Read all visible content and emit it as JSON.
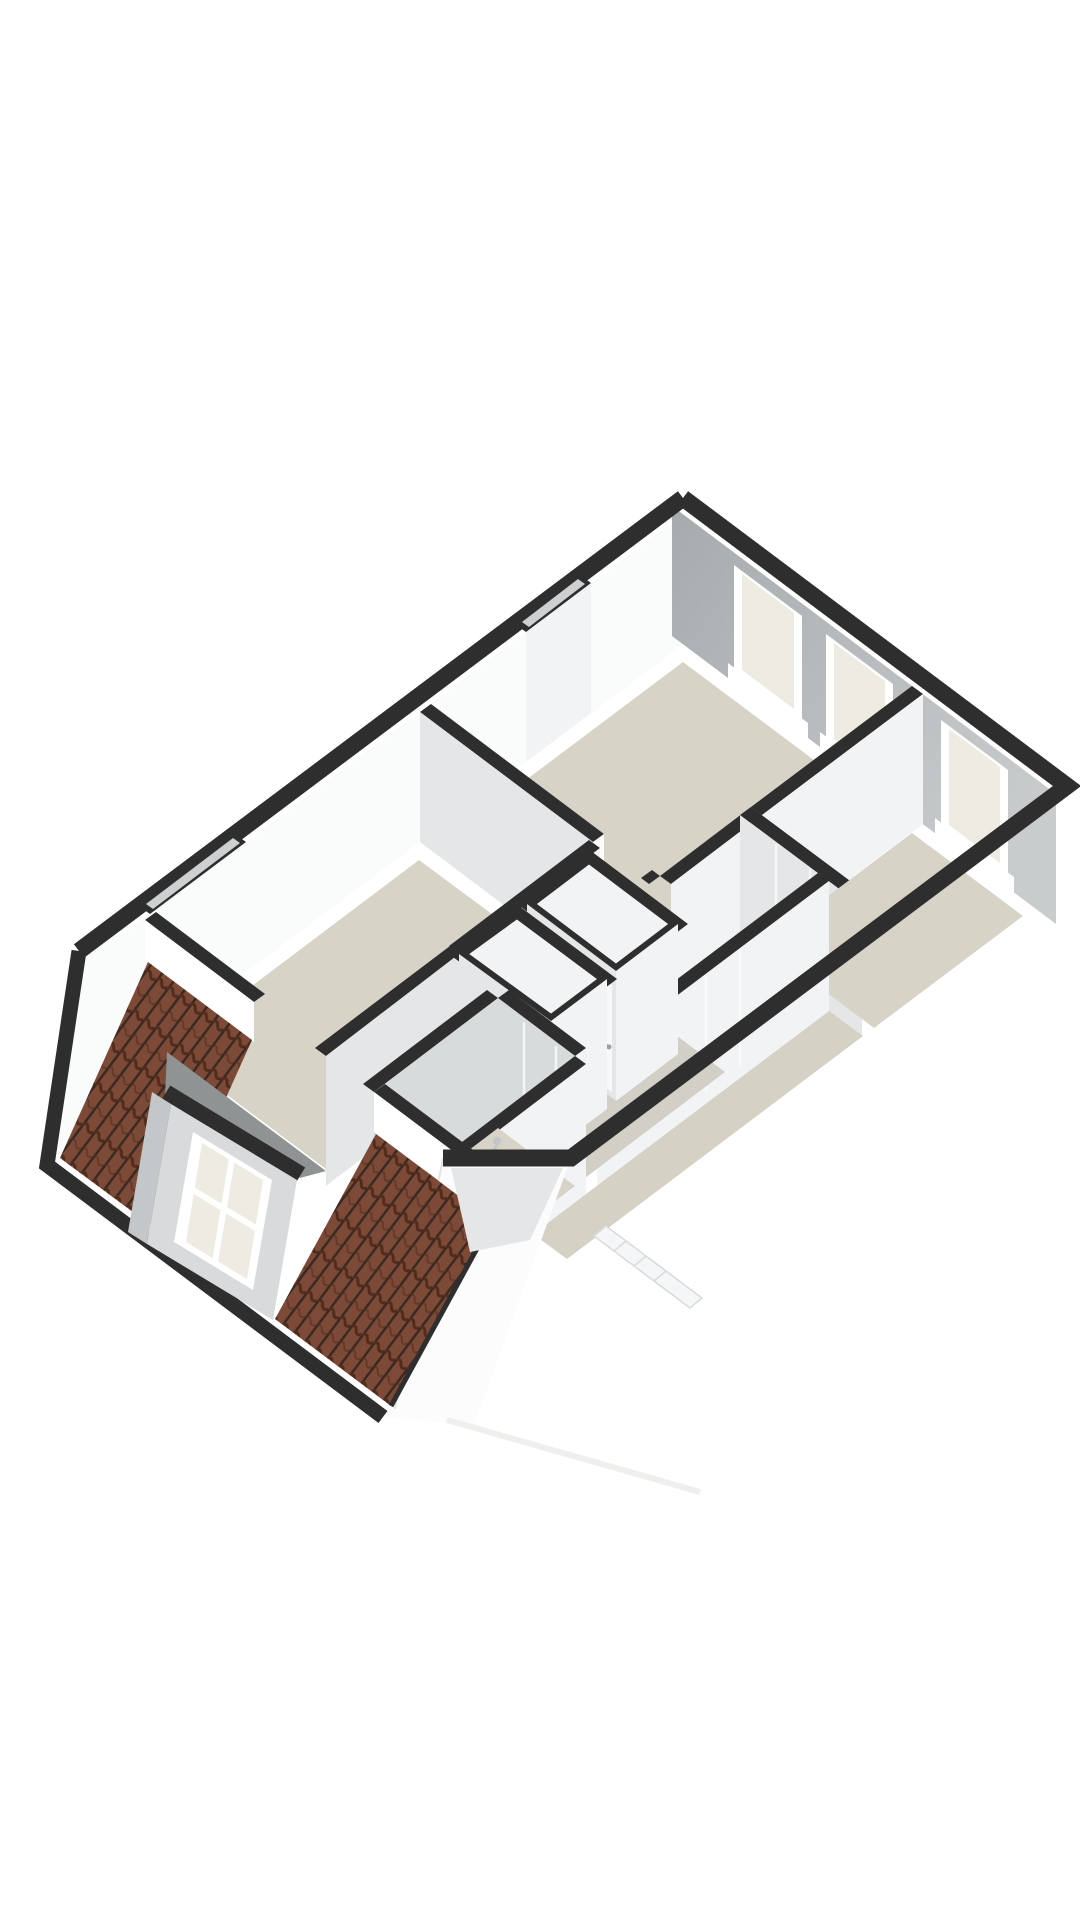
{
  "colors": {
    "page_bg": "#ffffff",
    "wall_top": "#2e2e2e",
    "slot_inner": "#cdd0d1",
    "ne_face_dark": "#a6abae",
    "ne_face_light": "#c9cccd",
    "nw_face": "#fafbfb",
    "int_light": "#f2f3f4",
    "int_mid": "#e4e6e7",
    "int_dark": "#d8dbdc",
    "cap_white": "#fdfdfd",
    "floor": "#d7d3c7",
    "floor_hall": "#d2cfc6",
    "floor_corridor": "#d5d1c5",
    "window_frame": "#ffffff",
    "window_glass": "#edebe2",
    "tile_base": "#7c4a37",
    "tile_gap": "#3a2a22",
    "tile_ridge": "#512c1d",
    "dormer_roof": "#909394",
    "dormer_cheek": "#c4c7c9",
    "dormer_face": "#d8dadb",
    "door": "#f7f8f9",
    "door_frame": "#ffffff",
    "handle": "#9aa0a4",
    "wood_light": "#cfa878",
    "wood_dark": "#b58c5c",
    "wood_line": "#a8825a",
    "basin": "#fbfcfc",
    "bowl": "#e9ecec",
    "faucet": "#c2c6c8",
    "hip_face": "#fcfcfd",
    "hip_edge": "#e2e3e4",
    "step": "#f5f6f7",
    "step_edge": "#d9dbdc",
    "shadow": "#ececeb",
    "knee_face": "#ffffff"
  }
}
